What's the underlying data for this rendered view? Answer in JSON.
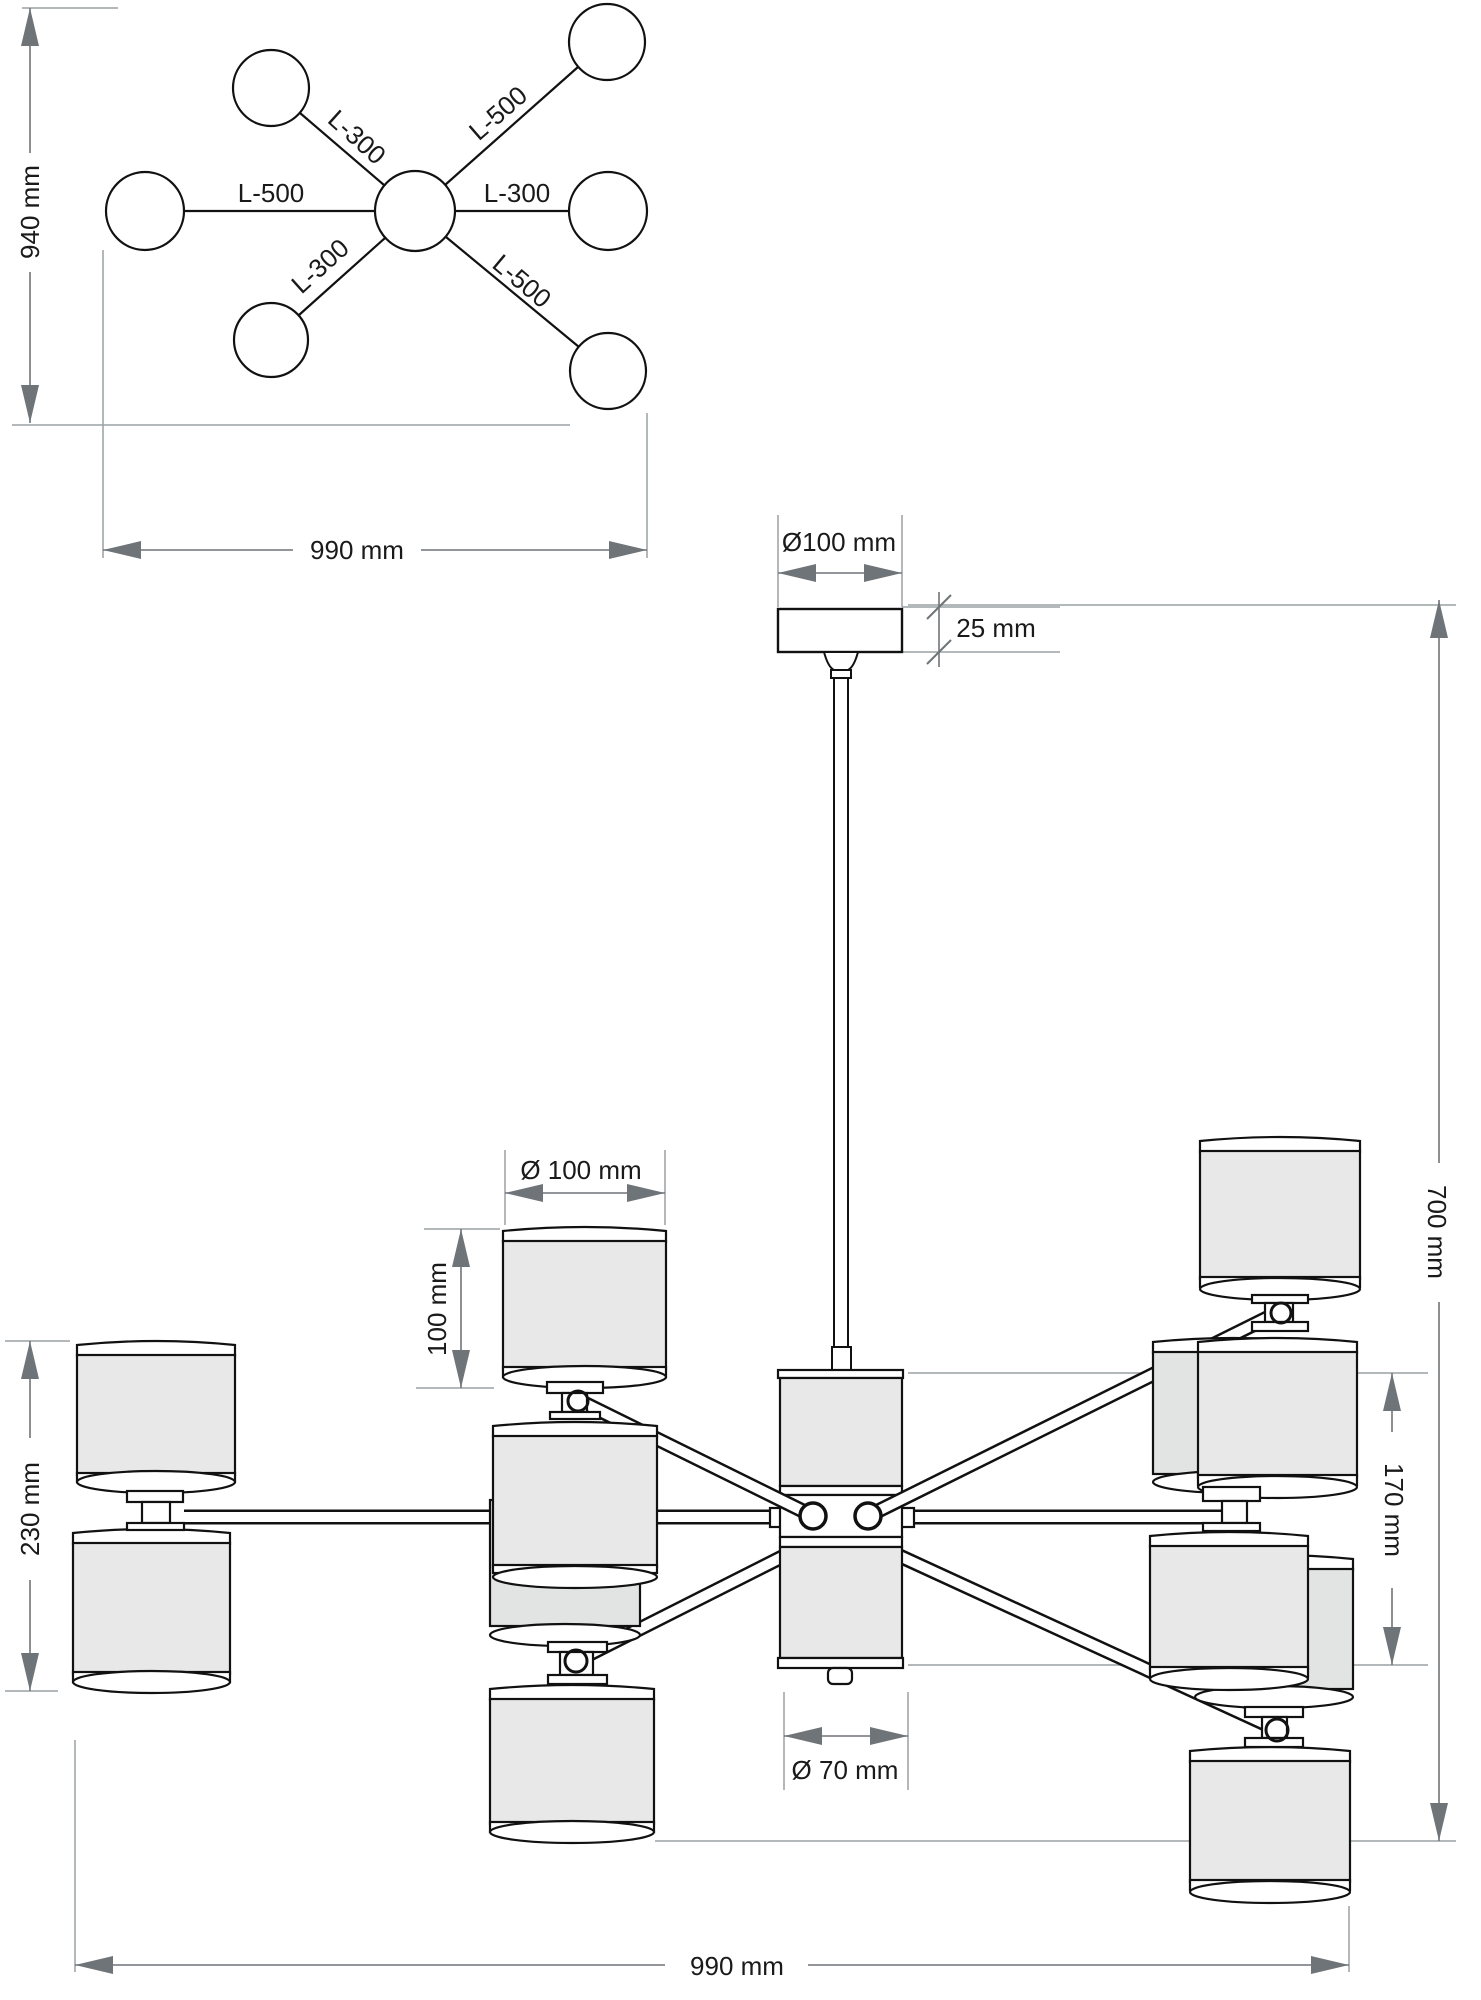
{
  "drawing": {
    "type": "chandelier technical dimension drawing",
    "views": [
      "plan view",
      "side elevation"
    ]
  },
  "colors": {
    "fixture_line": "#111111",
    "shade_fill": "#e8e8e8",
    "dimension": "#6f7478",
    "extension": "#9aa0a4",
    "text": "#1a1a1a",
    "background": "#ffffff"
  },
  "plan_view": {
    "height_label": "940 mm",
    "width_label": "990 mm",
    "arms": {
      "left": "L-500",
      "right": "L-300",
      "upper_left": "L-300",
      "upper_right": "L-500",
      "lower_left": "L-300",
      "lower_right": "L-500"
    }
  },
  "side_view": {
    "canopy_diameter_label": "Ø100 mm",
    "canopy_height_label": "25 mm",
    "overall_height_label": "700 mm",
    "shade_diameter_label": "Ø 100 mm",
    "shade_height_label": "100 mm",
    "body_height_label": "170 mm",
    "body_diameter_label": "Ø 70 mm",
    "shade_pair_height_label": "230 mm",
    "overall_width_label": "990 mm"
  }
}
